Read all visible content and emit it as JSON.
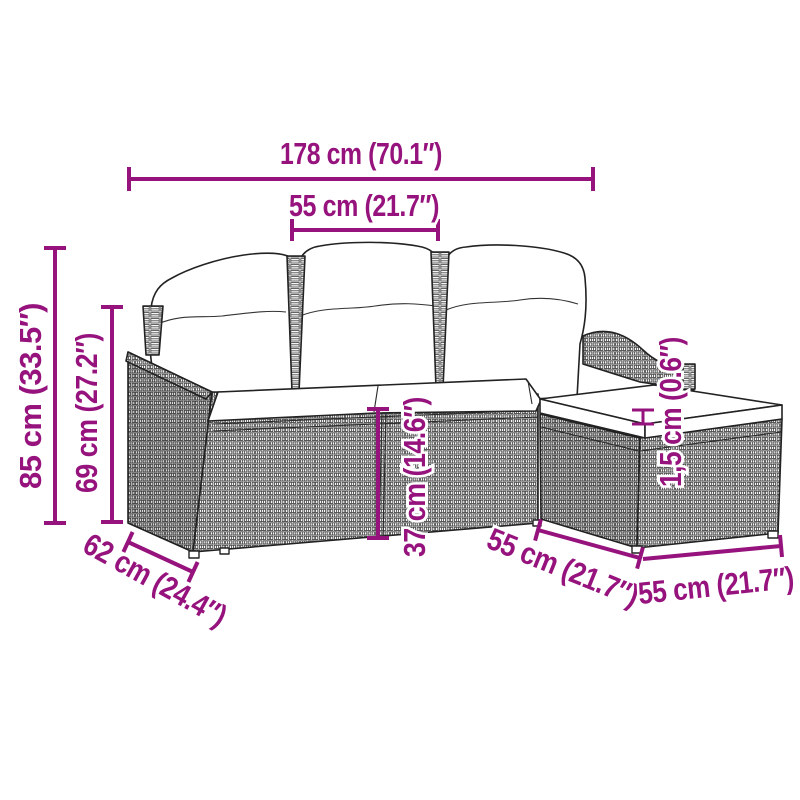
{
  "diagram": {
    "background_color": "#ffffff",
    "accent_color": "#96137D",
    "line_art_color": "#222222",
    "subject": "poly-rattan garden sofa set (3 seat sections with back cushions, seat cushions and footstool with cushion)"
  },
  "dimensions": {
    "total_width": {
      "label": "178 cm (70.1″)",
      "cm": 178,
      "inches": 70.1
    },
    "seat_width": {
      "label": "55 cm (21.7″)",
      "cm": 55,
      "inches": 21.7
    },
    "total_height": {
      "label": "85 cm (33.5″)",
      "cm": 85,
      "inches": 33.5
    },
    "back_height": {
      "label": "69 cm (27.2″)",
      "cm": 69,
      "inches": 27.2
    },
    "seat_height": {
      "label": "37 cm (14.6″)",
      "cm": 37,
      "inches": 14.6
    },
    "depth": {
      "label": "62 cm (24.4″)",
      "cm": 62,
      "inches": 24.4
    },
    "footstool_depth": {
      "label": "55 cm (21.7″)",
      "cm": 55,
      "inches": 21.7
    },
    "footstool_width": {
      "label": "55 cm (21.7″)",
      "cm": 55,
      "inches": 21.7
    },
    "cushion_thickness": {
      "label": "1,5 cm (0.6″)",
      "cm": 1.5,
      "inches": 0.6
    }
  }
}
